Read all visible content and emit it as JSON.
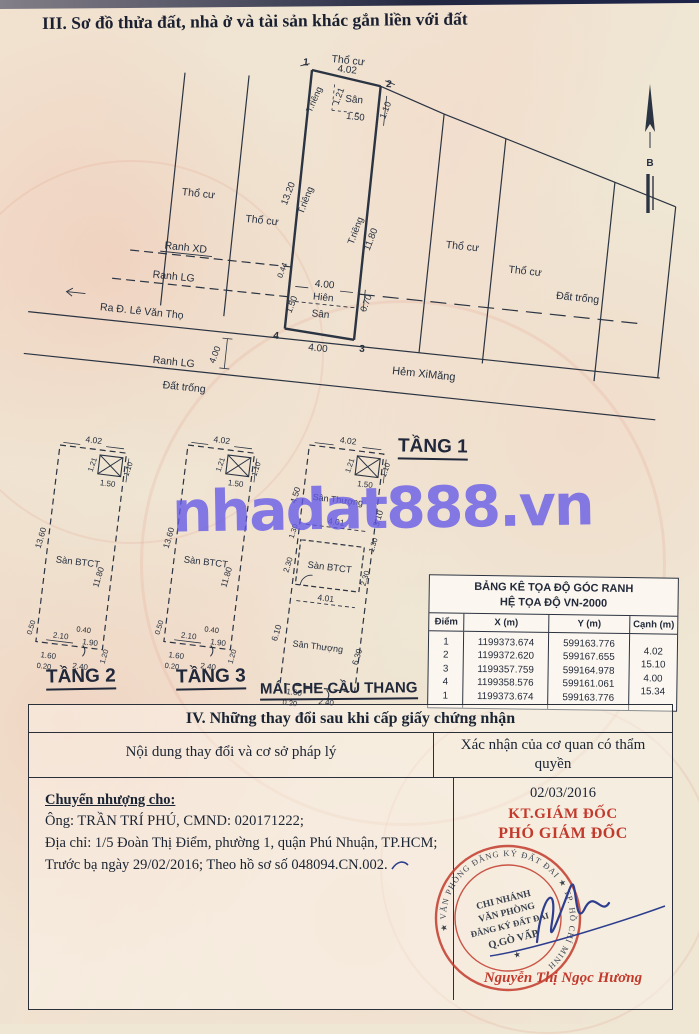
{
  "page": {
    "title3": "III. Sơ đồ thửa đất, nhà ở và tài sản khác gắn liền với đất",
    "watermark": "nhadat888.vn"
  },
  "diagram": {
    "labels": {
      "tho_cu": "Thổ cư",
      "dat_trong": "Đất trống",
      "t_rieng": "T.riêng",
      "san": "Sân",
      "hien": "Hiên",
      "ranh_xd": "Ranh XD",
      "ranh_lg": "Ranh LG",
      "road": "Ra Đ. Lê Văn Thọ",
      "hem": "Hẻm XiMăng",
      "tang1": "TẦNG 1",
      "north": "B"
    },
    "points": {
      "p1": "1",
      "p2": "2",
      "p3": "3",
      "p4": "4"
    },
    "dims": {
      "d402": "4.02",
      "d121": "1.21",
      "d150": "1.50",
      "d110": "1.10",
      "d1320": "13.20",
      "d1180": "11.80",
      "d044": "0.44",
      "d400": "4.00",
      "d070": "0.70"
    }
  },
  "floorplans": {
    "san_btct": "Sàn BTCT",
    "tang2_title": "TẦNG 2",
    "tang3_title": "TẦNG 3",
    "dims": {
      "d402": "4.02",
      "d121": "1.21",
      "d110": "1.10",
      "d150": "1.50",
      "d1360": "13.60",
      "d1180": "11.80",
      "d050": "0.50",
      "d210": "2.10",
      "d040": "0.40",
      "d190": "1.90",
      "d120": "1.20",
      "d160": "1.60",
      "d020": "0.20",
      "d240": "2.40"
    },
    "mai": {
      "title": "MÁI CHE CẦU THANG",
      "san_thuong": "Sân Thượng",
      "d450": "4.50",
      "d310": "3.10",
      "d401": "4.01",
      "d130": "1.30",
      "d230": "2.30",
      "d610": "6.10",
      "d630": "6.30"
    }
  },
  "coord_table": {
    "title1": "BẢNG KÊ TỌA ĐỘ GÓC RANH",
    "title2": "HỆ TỌA ĐỘ VN-2000",
    "headers": {
      "diem": "Điểm",
      "x": "X (m)",
      "y": "Y (m)",
      "canh": "Cạnh (m)"
    },
    "rows": [
      {
        "diem": "1",
        "x": "1199373.674",
        "y": "599163.776"
      },
      {
        "diem": "2",
        "x": "1199372.620",
        "y": "599167.655"
      },
      {
        "diem": "3",
        "x": "1199357.759",
        "y": "599164.978"
      },
      {
        "diem": "4",
        "x": "1199358.576",
        "y": "599161.061"
      },
      {
        "diem": "1",
        "x": "1199373.674",
        "y": "599163.776"
      }
    ],
    "canh": [
      "4.02",
      "15.10",
      "4.00",
      "15.34"
    ]
  },
  "section4": {
    "title": "IV. Những thay đổi sau khi cấp giấy chứng nhận",
    "col1": "Nội dung thay đổi và cơ sở pháp lý",
    "col2": "Xác nhận của cơ quan có thẩm quyền",
    "transfer_heading": "Chuyển nhượng cho:",
    "line1": "Ông: TRẦN TRÍ PHÚ, CMND: 020171222;",
    "line2": "Địa chỉ: 1/5 Đoàn Thị Điểm, phường 1, quận Phú Nhuận, TP.HCM;",
    "line3": "Trước bạ ngày 29/02/2016; Theo hồ sơ số 048094.CN.002.",
    "date": "02/03/2016",
    "kt": "KT.GIÁM ĐỐC",
    "pho": "PHÓ GIÁM ĐỐC",
    "stamp": {
      "l1": "CHI NHÁNH",
      "l2": "VĂN PHÒNG",
      "l3": "ĐĂNG KÝ ĐẤT ĐAI",
      "l4": "Q.GÒ VẤP",
      "ring": "★ VĂN PHÒNG ĐĂNG KÝ ĐẤT ĐAI ★ TP. HỒ CHÍ MINH"
    },
    "signer": "Nguyễn Thị Ngọc Hương"
  },
  "colors": {
    "stamp_red": "#c23a2c",
    "ink": "#26303f",
    "watermark_purple": "#645ae8",
    "signature_blue": "#2e3e8e"
  }
}
